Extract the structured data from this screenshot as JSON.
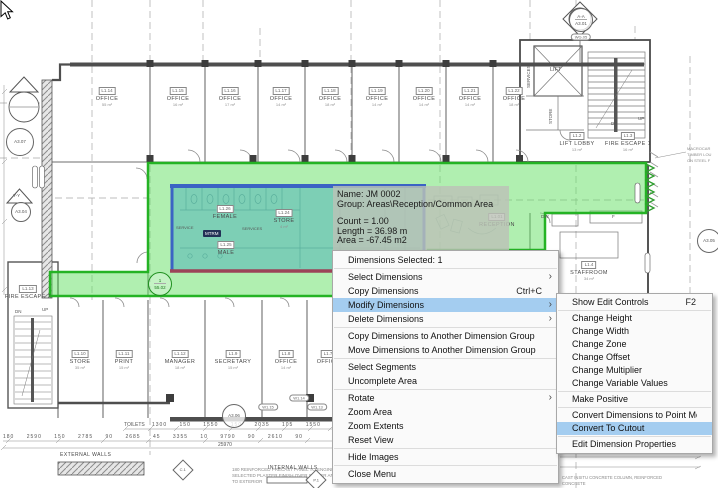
{
  "tooltip": {
    "lines": [
      {
        "t": "Name: JM 0002"
      },
      {
        "t": "Group: Areas\\Reception/Common Area"
      },
      {
        "t": "",
        "cls": "blank"
      },
      {
        "t": "Count = 1.00"
      },
      {
        "t": "Length = 36.98 m"
      },
      {
        "t": "Area = -67.45 m2"
      }
    ]
  },
  "context_menu": {
    "items": [
      {
        "type": "header",
        "label": "Dimensions Selected: 1"
      },
      {
        "type": "separator"
      },
      {
        "type": "item",
        "label": "Select Dimensions",
        "submenu": true
      },
      {
        "type": "item",
        "label": "Copy Dimensions",
        "shortcut": "Ctrl+C"
      },
      {
        "type": "item",
        "label": "Modify Dimensions",
        "submenu": true,
        "highlighted": true
      },
      {
        "type": "item",
        "label": "Delete Dimensions",
        "submenu": true
      },
      {
        "type": "separator"
      },
      {
        "type": "item",
        "label": "Copy Dimensions to Another Dimension Group"
      },
      {
        "type": "item",
        "label": "Move Dimensions to Another Dimension Group"
      },
      {
        "type": "separator"
      },
      {
        "type": "item",
        "label": "Select Segments"
      },
      {
        "type": "item",
        "label": "Uncomplete Area"
      },
      {
        "type": "separator"
      },
      {
        "type": "item",
        "label": "Rotate",
        "submenu": true
      },
      {
        "type": "item",
        "label": "Zoom Area"
      },
      {
        "type": "item",
        "label": "Zoom Extents"
      },
      {
        "type": "item",
        "label": "Reset View"
      },
      {
        "type": "separator"
      },
      {
        "type": "item",
        "label": "Hide Images"
      },
      {
        "type": "separator"
      },
      {
        "type": "item",
        "label": "Close Menu"
      }
    ]
  },
  "submenu": {
    "items": [
      {
        "type": "item",
        "label": "Show Edit Controls",
        "shortcut": "F2"
      },
      {
        "type": "separator"
      },
      {
        "type": "item",
        "label": "Change Height"
      },
      {
        "type": "item",
        "label": "Change Width"
      },
      {
        "type": "item",
        "label": "Change Zone"
      },
      {
        "type": "item",
        "label": "Change Offset"
      },
      {
        "type": "item",
        "label": "Change Multiplier"
      },
      {
        "type": "item",
        "label": "Change Variable Values"
      },
      {
        "type": "separator"
      },
      {
        "type": "item",
        "label": "Make Positive"
      },
      {
        "type": "separator"
      },
      {
        "type": "item",
        "label": "Convert Dimensions to Point Mode"
      },
      {
        "type": "item",
        "label": "Convert To Cutout",
        "highlighted": true
      },
      {
        "type": "separator"
      },
      {
        "type": "item",
        "label": "Edit Dimension Properties"
      }
    ]
  },
  "plan": {
    "rooms": [
      {
        "tag": "L1.14",
        "name": "OFFICE",
        "area": "55 m²",
        "x": 107,
        "y": 87
      },
      {
        "tag": "L1.15",
        "name": "OFFICE",
        "area": "16 m²",
        "x": 178,
        "y": 87
      },
      {
        "tag": "L1.16",
        "name": "OFFICE",
        "area": "17 m²",
        "x": 230,
        "y": 87
      },
      {
        "tag": "L1.17",
        "name": "OFFICE",
        "area": "14 m²",
        "x": 281,
        "y": 87
      },
      {
        "tag": "L1.18",
        "name": "OFFICE",
        "area": "18 m²",
        "x": 330,
        "y": 87
      },
      {
        "tag": "L1.19",
        "name": "OFFICE",
        "area": "14 m²",
        "x": 377,
        "y": 87
      },
      {
        "tag": "L1.20",
        "name": "OFFICE",
        "area": "14 m²",
        "x": 424,
        "y": 87
      },
      {
        "tag": "L1.21",
        "name": "OFFICE",
        "area": "14 m²",
        "x": 470,
        "y": 87
      },
      {
        "tag": "L1.22",
        "name": "OFFICE",
        "area": "18 m²",
        "x": 514,
        "y": 87
      },
      {
        "tag": "L1.26",
        "name": "FEMALE",
        "x": 225,
        "y": 205
      },
      {
        "tag": "L1.24",
        "name": "STORE",
        "area": "4 m²",
        "x": 284,
        "y": 209
      },
      {
        "tag": "L1.25",
        "name": "MALE",
        "x": 226,
        "y": 241
      },
      {
        "tag": "L1.01",
        "name": "RECEPTION",
        "x": 497,
        "y": 213
      },
      {
        "tag": "L1.2",
        "name": "LIFT LOBBY",
        "area": "13 m²",
        "x": 577,
        "y": 132
      },
      {
        "tag": "L1.3",
        "name": "FIRE ESCAPE 1",
        "area": "16 m²",
        "x": 628,
        "y": 132
      },
      {
        "tag": "L1.4",
        "name": "STAFFROOM",
        "area": "34 m²",
        "x": 589,
        "y": 261
      },
      {
        "tag": "L1.13",
        "name": "FIRE ESCAPE 2",
        "x": 28,
        "y": 285
      },
      {
        "tag": "L1.10",
        "name": "STORE",
        "area": "35 m²",
        "x": 80,
        "y": 350
      },
      {
        "tag": "L1.11",
        "name": "PRINT",
        "area": "15 m²",
        "x": 124,
        "y": 350
      },
      {
        "tag": "L1.12",
        "name": "MANAGER",
        "area": "18 m²",
        "x": 180,
        "y": 350
      },
      {
        "tag": "L1.9",
        "name": "SECRETARY",
        "area": "15 m²",
        "x": 233,
        "y": 350
      },
      {
        "tag": "L1.8",
        "name": "OFFICE",
        "area": "14 m²",
        "x": 286,
        "y": 350
      },
      {
        "tag": "L1.7",
        "name": "OFFICE",
        "x": 328,
        "y": 350
      }
    ],
    "texts": [
      {
        "t": "LIFT",
        "x": 550,
        "y": 67,
        "s": 5.5
      },
      {
        "t": "SERVICES",
        "x": 527,
        "y": 88,
        "s": 4.5,
        "rot": -90
      },
      {
        "t": "STORE",
        "x": 549,
        "y": 124,
        "s": 4.5,
        "rot": -90
      },
      {
        "t": "UP",
        "x": 638,
        "y": 117,
        "s": 4.5
      },
      {
        "t": "DN",
        "x": 611,
        "y": 122,
        "s": 4.5
      },
      {
        "t": "UP",
        "x": 42,
        "y": 308,
        "s": 4.5
      },
      {
        "t": "DN",
        "x": 15,
        "y": 310,
        "s": 4.5
      },
      {
        "t": "DW",
        "x": 541,
        "y": 215,
        "s": 4.5
      },
      {
        "t": "F",
        "x": 612,
        "y": 215,
        "s": 4.5
      },
      {
        "t": "SERVICE",
        "x": 176,
        "y": 226,
        "s": 4
      },
      {
        "t": "SERVICES",
        "x": 242,
        "y": 227,
        "s": 4
      },
      {
        "t": "MTRM",
        "x": 203,
        "y": 230,
        "s": 4.5,
        "cls": "darkbox"
      },
      {
        "t": "Y-Y",
        "x": 13,
        "y": 194,
        "s": 4.5
      },
      {
        "t": "EXTERNAL WALLS",
        "x": 60,
        "y": 453,
        "s": 5,
        "cls": "hd"
      },
      {
        "t": "INTERNAL WALLS",
        "x": 268,
        "y": 466,
        "s": 5,
        "cls": "hd"
      },
      {
        "t": "MACROCAR",
        "x": 687,
        "y": 147,
        "s": 4,
        "cls": "gray"
      },
      {
        "t": "TIMBER LOU",
        "x": 687,
        "y": 153,
        "s": 4,
        "cls": "gray"
      },
      {
        "t": "ON STEEL F",
        "x": 687,
        "y": 159,
        "s": 4,
        "cls": "gray"
      },
      {
        "t": "CAST INSITU CONCRETE COLUMN, REINFORCED",
        "x": 562,
        "y": 476,
        "s": 4.2,
        "cls": "gray"
      },
      {
        "t": "CONCRETE",
        "x": 562,
        "y": 482,
        "s": 4.2,
        "cls": "gray"
      },
      {
        "t": "180 REINFORCED PRECAST PANEL TO ENGINEERS DETAILS",
        "x": 232,
        "y": 468,
        "s": 4.5,
        "cls": "gray"
      },
      {
        "t": "SELECTED PLASTER FINISH OVER SEALER AND BASE COAT",
        "x": 232,
        "y": 474,
        "s": 4.5,
        "cls": "gray"
      },
      {
        "t": "TO EXTERIOR",
        "x": 232,
        "y": 480,
        "s": 4.5,
        "cls": "gray"
      },
      {
        "t": "TOILETS",
        "x": 124,
        "y": 423,
        "s": 5
      },
      {
        "t": "1300 150 1550 150 2035 105 1550 150 1235 90 6400",
        "x": 152,
        "y": 423,
        "s": 5,
        "cls": "dim"
      },
      {
        "t": "180 2590 150 2785 90 2685 45 3355 10 9790 90 2610 90",
        "x": 3,
        "y": 435,
        "s": 5,
        "cls": "dim"
      },
      {
        "t": "25970",
        "x": 218,
        "y": 443,
        "s": 5
      },
      {
        "t": "3570",
        "x": 373,
        "y": 450,
        "s": 5
      }
    ],
    "ovals": [
      {
        "t": "WG.05",
        "x": 581,
        "y": 37
      },
      {
        "t": "W1.14",
        "x": 299,
        "y": 398
      },
      {
        "t": "W1.15",
        "x": 268,
        "y": 407
      },
      {
        "t": "W1.13",
        "x": 317,
        "y": 407
      }
    ],
    "circles": [
      {
        "t": "A3.07",
        "x": 19,
        "y": 141,
        "r": 13
      },
      {
        "t": "A3.04",
        "x": 20,
        "y": 211,
        "r": 9
      },
      {
        "t": "A3.06",
        "x": 233,
        "y": 415,
        "r": 11
      },
      {
        "t": "A3.05",
        "x": 708,
        "y": 240,
        "r": 11
      },
      {
        "t": "A-A",
        "t2": "A3.01",
        "x": 580,
        "y": 19,
        "r": 11
      },
      {
        "t": "1",
        "t2": "55.02",
        "x": 159,
        "y": 283,
        "r": 11,
        "cls": "green"
      }
    ],
    "diamonds": [
      {
        "t": "C.1",
        "x": 183,
        "y": 470
      },
      {
        "t": "P.1",
        "x": 316,
        "y": 480
      }
    ]
  },
  "colors": {
    "selection_green_fill": "#61e061",
    "selection_green_border": "#24b324",
    "zone_blue_border": "#3b63c4",
    "zone_teal_fill": "#40a8bc",
    "zone_bottom_border": "#9c4458",
    "menu_highlight": "#a4cdf0"
  }
}
